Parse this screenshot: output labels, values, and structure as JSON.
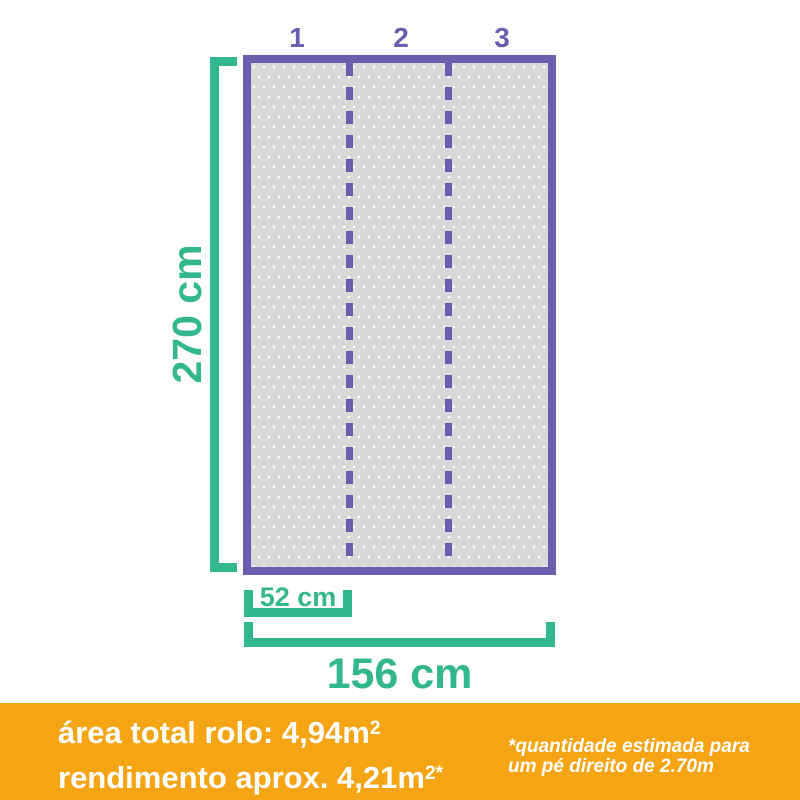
{
  "colors": {
    "purple": "#6A5FAE",
    "green": "#33B78E",
    "orange": "#F5A413",
    "roll_fill": "#D9D7D7",
    "dot": "#FFFFFF",
    "footer_text": "#FFFFFF"
  },
  "diagram": {
    "strip_labels": [
      "1",
      "2",
      "3"
    ],
    "height_label": "270 cm",
    "strip_width_label": "52 cm",
    "total_width_label": "156 cm"
  },
  "footer": {
    "area_text": "área total rolo: 4,94m",
    "area_sup": "2",
    "yield_text": "rendimento aprox. 4,21m",
    "yield_sup": "2*",
    "note_line1": "*quantidade estimada para",
    "note_line2": "um pé direito de 2.70m"
  }
}
